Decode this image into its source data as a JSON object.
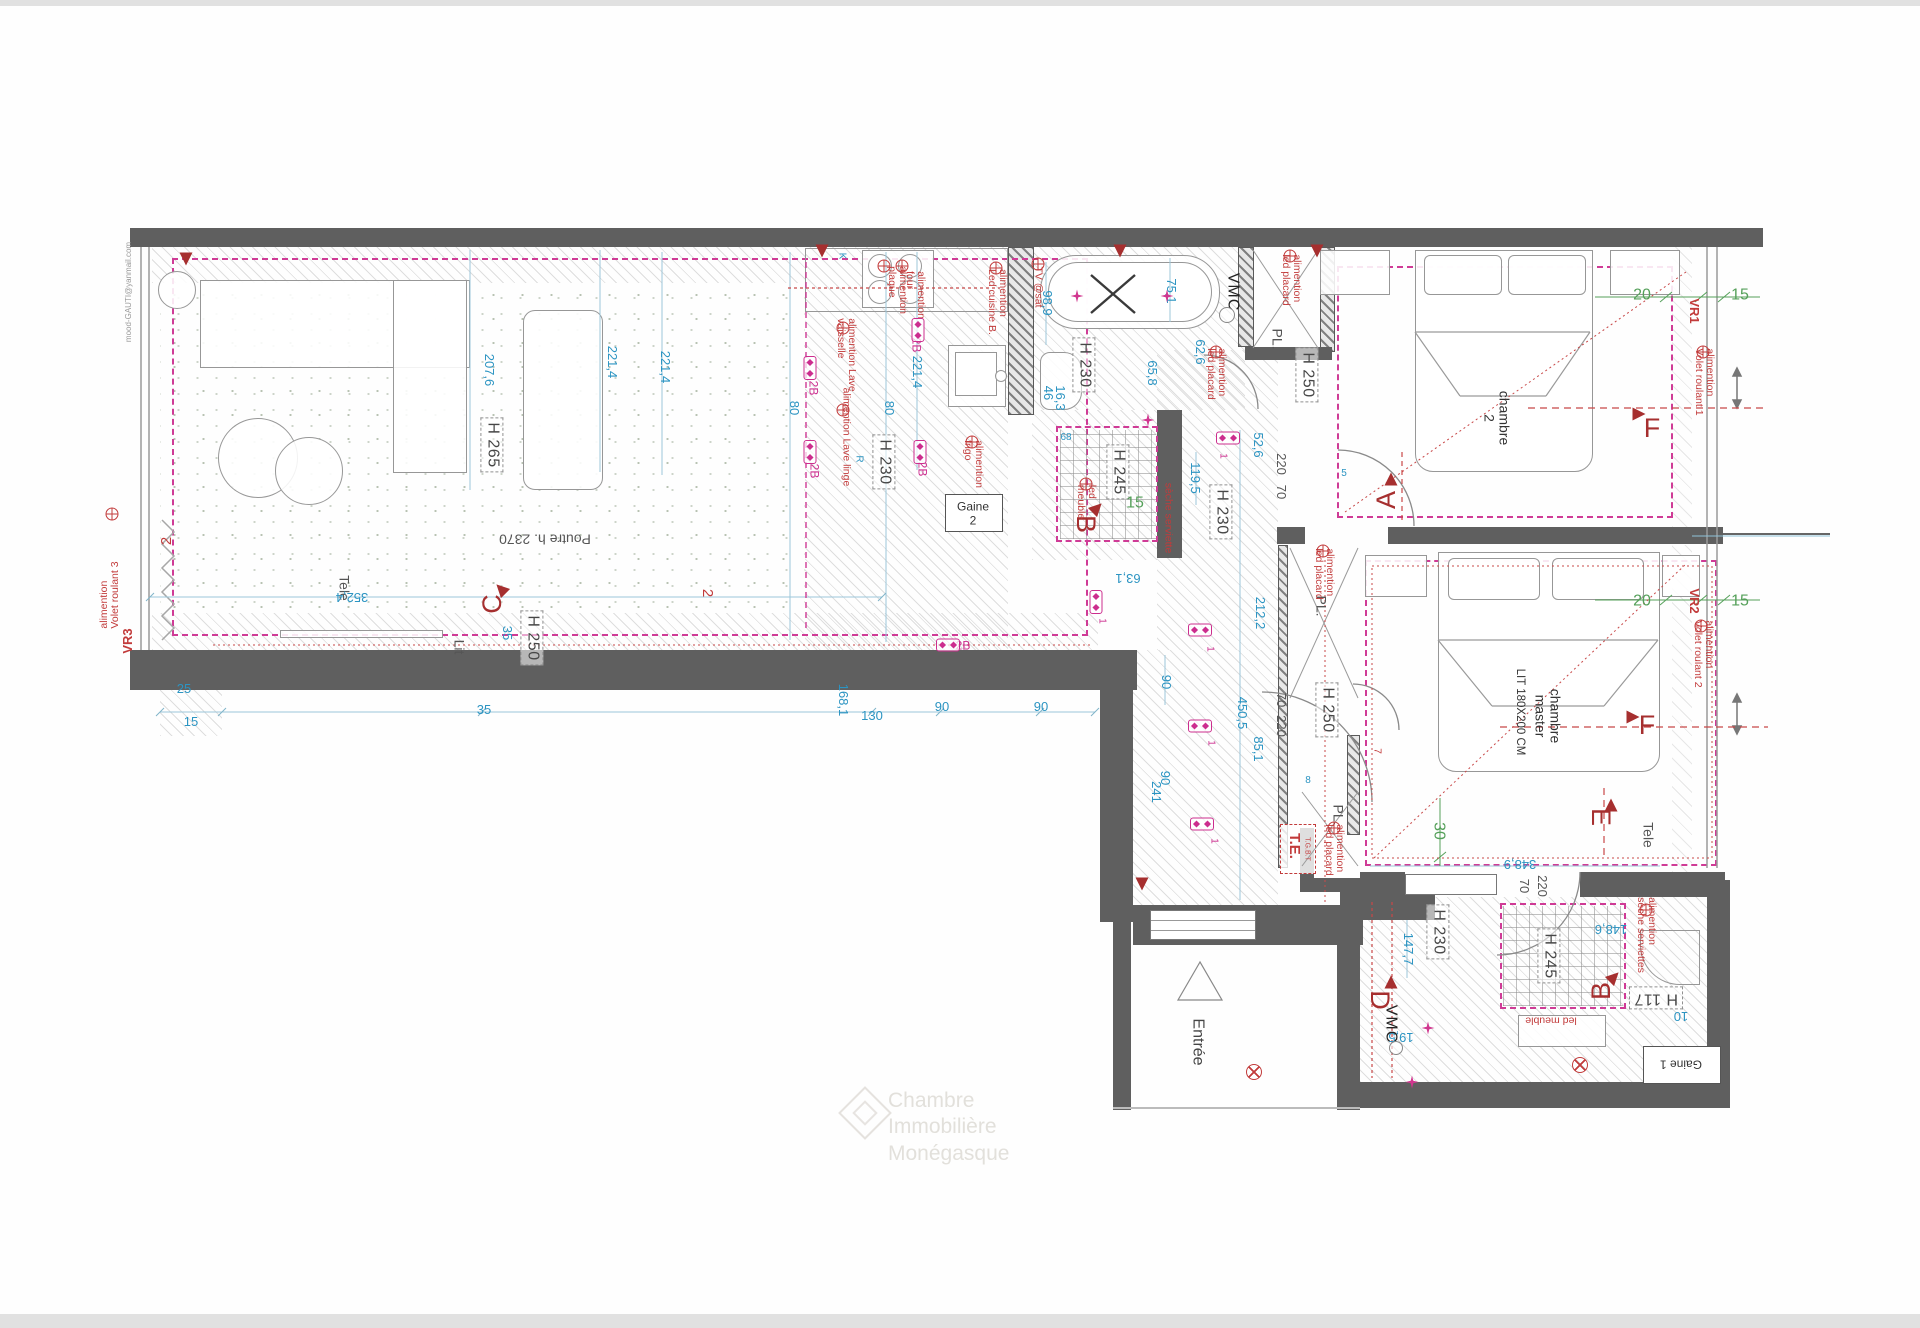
{
  "plan_title": "Plan appartement - implantation électrique",
  "watermark": {
    "line1": "Chambre",
    "line2": "Immobilière",
    "line3": "Monégasque"
  },
  "edge_note": "mood-GAUTI@yanmail.com",
  "colors": {
    "wall": "#5f5f5f",
    "dim_blue": "#2b94c2",
    "dim_green": "#55a05a",
    "note_red": "#c23b3b",
    "magenta": "#cc2d8e",
    "ceiling_dash": "#cf3b96"
  },
  "labels": [
    {
      "t": "H 265",
      "x": 492,
      "y": 445,
      "r": 90,
      "c": "hbox"
    },
    {
      "t": "H 230",
      "x": 884,
      "y": 462,
      "r": 90,
      "c": "hbox"
    },
    {
      "t": "H 250",
      "x": 532,
      "y": 638,
      "r": 90,
      "c": "hbox"
    },
    {
      "t": "H 230",
      "x": 1084,
      "y": 365,
      "r": 90,
      "c": "hbox"
    },
    {
      "t": "H 250",
      "x": 1307,
      "y": 375,
      "r": 90,
      "c": "hbox"
    },
    {
      "t": "H 230",
      "x": 1221,
      "y": 512,
      "r": 90,
      "c": "hbox"
    },
    {
      "t": "H 245",
      "x": 1118,
      "y": 472,
      "r": 90,
      "c": "hbox"
    },
    {
      "t": "H 250",
      "x": 1327,
      "y": 710,
      "r": 90,
      "c": "hbox"
    },
    {
      "t": "H 230",
      "x": 1438,
      "y": 932,
      "r": 90,
      "c": "hbox"
    },
    {
      "t": "H 245",
      "x": 1549,
      "y": 956,
      "r": 90,
      "c": "hbox"
    },
    {
      "t": "H 117",
      "x": 1656,
      "y": 998,
      "r": 180,
      "c": "hbox"
    },
    {
      "t": "Poutre h. 2370",
      "x": 545,
      "y": 539,
      "r": 180,
      "c": "graysm2"
    },
    {
      "t": "chambre\n2",
      "x": 1497,
      "y": 418,
      "r": 90,
      "c": "room"
    },
    {
      "t": "chambre\nmaster",
      "x": 1548,
      "y": 716,
      "r": 90,
      "c": "room"
    },
    {
      "t": "LIT 180X200 CM",
      "x": 1520,
      "y": 712,
      "r": 90,
      "c": "room-sm"
    },
    {
      "t": "Entrée",
      "x": 1197,
      "y": 1042,
      "r": 90,
      "c": "entree"
    },
    {
      "t": "Tele",
      "x": 344,
      "y": 588,
      "r": 90,
      "c": "graysm2"
    },
    {
      "t": "Tele",
      "x": 1648,
      "y": 835,
      "r": 90,
      "c": "graysm2"
    },
    {
      "t": "Lit",
      "x": 459,
      "y": 647,
      "r": 90,
      "c": "graysm2"
    },
    {
      "t": "VMC",
      "x": 1232,
      "y": 292,
      "r": 90,
      "c": "vmc"
    },
    {
      "t": "VMC",
      "x": 1390,
      "y": 1024,
      "r": 90,
      "c": "vmc"
    },
    {
      "t": "PL.",
      "x": 1277,
      "y": 339,
      "r": 90,
      "c": "graysm2"
    },
    {
      "t": "PL.",
      "x": 1321,
      "y": 606,
      "r": 90,
      "c": "graysm2"
    },
    {
      "t": "PL.",
      "x": 1338,
      "y": 815,
      "r": 90,
      "c": "graysm2"
    },
    {
      "t": "Gaine",
      "x": 973,
      "y": 507,
      "r": 0,
      "c": "gainetxt"
    },
    {
      "t": "2",
      "x": 973,
      "y": 521,
      "r": 0,
      "c": "gainetxt"
    },
    {
      "t": "Gaine 1",
      "x": 1681,
      "y": 1064,
      "r": 180,
      "c": "gainetxt"
    },
    {
      "t": "T.E.",
      "x": 1294,
      "y": 846,
      "r": 90,
      "c": "tebig"
    },
    {
      "t": "T.G.B.T",
      "x": 1307,
      "y": 849,
      "r": 90,
      "c": "tesm"
    },
    {
      "t": "207,6",
      "x": 489,
      "y": 370,
      "r": 90,
      "c": "dim"
    },
    {
      "t": "221,4",
      "x": 612,
      "y": 362,
      "r": 90,
      "c": "dim"
    },
    {
      "t": "221,4",
      "x": 665,
      "y": 367,
      "r": 90,
      "c": "dim"
    },
    {
      "t": "221,4",
      "x": 917,
      "y": 372,
      "r": 90,
      "c": "dim"
    },
    {
      "t": "80",
      "x": 794,
      "y": 408,
      "r": 90,
      "c": "dim"
    },
    {
      "t": "80",
      "x": 889,
      "y": 408,
      "r": 90,
      "c": "dim"
    },
    {
      "t": "352,4",
      "x": 352,
      "y": 597,
      "r": 180,
      "c": "dim"
    },
    {
      "t": "35",
      "x": 507,
      "y": 633,
      "r": 90,
      "c": "dim"
    },
    {
      "t": "25",
      "x": 184,
      "y": 689,
      "r": 0,
      "c": "dim"
    },
    {
      "t": "15",
      "x": 191,
      "y": 722,
      "r": 0,
      "c": "dim"
    },
    {
      "t": "35",
      "x": 484,
      "y": 710,
      "r": 0,
      "c": "dim"
    },
    {
      "t": "168,1",
      "x": 843,
      "y": 700,
      "r": 90,
      "c": "dim"
    },
    {
      "t": "130",
      "x": 872,
      "y": 716,
      "r": 0,
      "c": "dim"
    },
    {
      "t": "90",
      "x": 942,
      "y": 707,
      "r": 0,
      "c": "dim"
    },
    {
      "t": "90",
      "x": 1041,
      "y": 707,
      "r": 0,
      "c": "dim"
    },
    {
      "t": "98,9",
      "x": 1047,
      "y": 303,
      "r": 90,
      "c": "dim"
    },
    {
      "t": "75,1",
      "x": 1171,
      "y": 291,
      "r": 90,
      "c": "dim"
    },
    {
      "t": "46",
      "x": 1048,
      "y": 393,
      "r": 90,
      "c": "dim"
    },
    {
      "t": "16,3",
      "x": 1060,
      "y": 398,
      "r": 90,
      "c": "dim"
    },
    {
      "t": "65,8",
      "x": 1152,
      "y": 373,
      "r": 90,
      "c": "dim"
    },
    {
      "t": "62,6",
      "x": 1200,
      "y": 352,
      "r": 90,
      "c": "dim"
    },
    {
      "t": "52,6",
      "x": 1258,
      "y": 445,
      "r": 90,
      "c": "dim"
    },
    {
      "t": "119,5",
      "x": 1195,
      "y": 478,
      "r": 90,
      "c": "dim"
    },
    {
      "t": "212,2",
      "x": 1260,
      "y": 613,
      "r": 90,
      "c": "dim"
    },
    {
      "t": "63,1",
      "x": 1128,
      "y": 578,
      "r": 180,
      "c": "dim"
    },
    {
      "t": "90",
      "x": 1166,
      "y": 682,
      "r": 90,
      "c": "dim"
    },
    {
      "t": "450,5",
      "x": 1242,
      "y": 713,
      "r": 90,
      "c": "dim"
    },
    {
      "t": "85,1",
      "x": 1258,
      "y": 749,
      "r": 90,
      "c": "dim"
    },
    {
      "t": "90",
      "x": 1165,
      "y": 778,
      "r": 90,
      "c": "dim"
    },
    {
      "t": "241",
      "x": 1156,
      "y": 792,
      "r": 90,
      "c": "dim"
    },
    {
      "t": "147,7",
      "x": 1408,
      "y": 949,
      "r": 90,
      "c": "dim"
    },
    {
      "t": "148,6",
      "x": 1611,
      "y": 929,
      "r": 180,
      "c": "dim"
    },
    {
      "t": "19,5",
      "x": 1401,
      "y": 1037,
      "r": 180,
      "c": "dim"
    },
    {
      "t": "10",
      "x": 1681,
      "y": 1016,
      "r": 180,
      "c": "dim"
    },
    {
      "t": "348,9",
      "x": 1520,
      "y": 864,
      "r": 180,
      "c": "dim"
    },
    {
      "t": "68",
      "x": 1066,
      "y": 438,
      "r": 0,
      "c": "dimsm"
    },
    {
      "t": "5",
      "x": 1344,
      "y": 474,
      "r": 0,
      "c": "dimsm"
    },
    {
      "t": "8",
      "x": 1308,
      "y": 781,
      "r": 0,
      "c": "dimsm"
    },
    {
      "t": "R",
      "x": 858,
      "y": 459,
      "r": 90,
      "c": "dimsm"
    },
    {
      "t": "K",
      "x": 841,
      "y": 256,
      "r": 90,
      "c": "dimsm"
    },
    {
      "t": "220",
      "x": 1281,
      "y": 464,
      "r": 90,
      "c": "dimgray"
    },
    {
      "t": "70",
      "x": 1281,
      "y": 492,
      "r": 90,
      "c": "dimgray"
    },
    {
      "t": "70",
      "x": 1281,
      "y": 700,
      "r": 90,
      "c": "dimgray"
    },
    {
      "t": "220",
      "x": 1281,
      "y": 726,
      "r": 90,
      "c": "dimgray"
    },
    {
      "t": "70",
      "x": 1524,
      "y": 886,
      "r": 90,
      "c": "dimgray"
    },
    {
      "t": "220",
      "x": 1542,
      "y": 886,
      "r": 90,
      "c": "dimgray"
    },
    {
      "t": "20",
      "x": 1642,
      "y": 296,
      "r": 0,
      "c": "dimg"
    },
    {
      "t": "15",
      "x": 1740,
      "y": 296,
      "r": 0,
      "c": "dimg"
    },
    {
      "t": "20",
      "x": 1642,
      "y": 602,
      "r": 0,
      "c": "dimg"
    },
    {
      "t": "15",
      "x": 1740,
      "y": 602,
      "r": 0,
      "c": "dimg"
    },
    {
      "t": "15",
      "x": 1135,
      "y": 504,
      "r": 0,
      "c": "dimg"
    },
    {
      "t": "30",
      "x": 1438,
      "y": 831,
      "r": 90,
      "c": "dimg"
    },
    {
      "t": "C",
      "x": 492,
      "y": 604,
      "r": 270,
      "c": "marker"
    },
    {
      "t": "A",
      "x": 1386,
      "y": 500,
      "r": 270,
      "c": "marker"
    },
    {
      "t": "F",
      "x": 1652,
      "y": 428,
      "r": 0,
      "c": "marker"
    },
    {
      "t": "F",
      "x": 1647,
      "y": 725,
      "r": 0,
      "c": "marker"
    },
    {
      "t": "E",
      "x": 1601,
      "y": 817,
      "r": 90,
      "c": "marker"
    },
    {
      "t": "B",
      "x": 1086,
      "y": 524,
      "r": 90,
      "c": "marker"
    },
    {
      "t": "B",
      "x": 1601,
      "y": 991,
      "r": 270,
      "c": "marker"
    },
    {
      "t": "D",
      "x": 1380,
      "y": 1000,
      "r": 90,
      "c": "marker"
    },
    {
      "t": "2",
      "x": 167,
      "y": 541,
      "r": 270,
      "c": "redmid"
    },
    {
      "t": "2",
      "x": 707,
      "y": 593,
      "r": 90,
      "c": "redmid"
    },
    {
      "t": "7",
      "x": 1376,
      "y": 751,
      "r": 90,
      "c": "redsm"
    },
    {
      "t": "alimention\nVolet roulant 3",
      "x": 110,
      "y": 595,
      "r": 270,
      "c": "red"
    },
    {
      "t": "VR3",
      "x": 128,
      "y": 641,
      "r": 270,
      "c": "vr"
    },
    {
      "t": "TV @sat",
      "x": 1038,
      "y": 287,
      "r": 90,
      "c": "red"
    },
    {
      "t": "alimention\nplaque",
      "x": 897,
      "y": 290,
      "r": 90,
      "c": "red"
    },
    {
      "t": "alimention\nfour",
      "x": 915,
      "y": 295,
      "r": 90,
      "c": "red"
    },
    {
      "t": "alimention\nLed cuisine B.",
      "x": 997,
      "y": 302,
      "r": 90,
      "c": "red"
    },
    {
      "t": "alimention Lave\nvaisselle",
      "x": 846,
      "y": 355,
      "r": 90,
      "c": "red"
    },
    {
      "t": "alimention Lave linge",
      "x": 846,
      "y": 437,
      "r": 90,
      "c": "red"
    },
    {
      "t": "alimention\nfrigo",
      "x": 973,
      "y": 464,
      "r": 90,
      "c": "red"
    },
    {
      "t": "alimention\nled placard",
      "x": 1291,
      "y": 280,
      "r": 90,
      "c": "red"
    },
    {
      "t": "alimention\nled placard",
      "x": 1216,
      "y": 374,
      "r": 90,
      "c": "red"
    },
    {
      "t": "alimention\nled placard",
      "x": 1324,
      "y": 574,
      "r": 90,
      "c": "red"
    },
    {
      "t": "alimention\nled placard",
      "x": 1334,
      "y": 850,
      "r": 90,
      "c": "red"
    },
    {
      "t": "sèche serviette",
      "x": 1168,
      "y": 518,
      "r": 90,
      "c": "red"
    },
    {
      "t": "alimention\nsèche serviettes",
      "x": 1646,
      "y": 935,
      "r": 90,
      "c": "red"
    },
    {
      "t": "led meuble",
      "x": 1551,
      "y": 1020,
      "r": 180,
      "c": "red"
    },
    {
      "t": "led\nmeuble",
      "x": 1086,
      "y": 502,
      "r": 90,
      "c": "red"
    },
    {
      "t": "VR1",
      "x": 1694,
      "y": 311,
      "r": 90,
      "c": "vr"
    },
    {
      "t": "alimention\nVolet roulant 1",
      "x": 1704,
      "y": 382,
      "r": 90,
      "c": "red"
    },
    {
      "t": "VR2",
      "x": 1694,
      "y": 601,
      "r": 90,
      "c": "vr"
    },
    {
      "t": "alimention\nVolet roulant 2",
      "x": 1703,
      "y": 654,
      "r": 90,
      "c": "red"
    },
    {
      "t": "2B",
      "x": 813,
      "y": 388,
      "r": 90,
      "c": "mag"
    },
    {
      "t": "2B",
      "x": 814,
      "y": 471,
      "r": 90,
      "c": "mag"
    },
    {
      "t": "2B",
      "x": 916,
      "y": 345,
      "r": 90,
      "c": "mag"
    },
    {
      "t": "2B",
      "x": 922,
      "y": 469,
      "r": 90,
      "c": "mag"
    },
    {
      "t": "2B",
      "x": 963,
      "y": 646,
      "r": 0,
      "c": "mag"
    },
    {
      "t": "1",
      "x": 1222,
      "y": 456,
      "r": 90,
      "c": "magsm"
    },
    {
      "t": "1",
      "x": 1101,
      "y": 621,
      "r": 90,
      "c": "magsm"
    },
    {
      "t": "1",
      "x": 1209,
      "y": 649,
      "r": 90,
      "c": "magsm"
    },
    {
      "t": "1",
      "x": 1210,
      "y": 743,
      "r": 90,
      "c": "magsm"
    },
    {
      "t": "1",
      "x": 1213,
      "y": 841,
      "r": 90,
      "c": "magsm"
    },
    {
      "t": "mood-GAUTI@yanmail.com",
      "x": 129,
      "y": 292,
      "r": 270,
      "c": "email"
    }
  ],
  "symbols": {
    "sockets": [
      [
        810,
        368,
        90
      ],
      [
        810,
        452,
        90
      ],
      [
        918,
        330,
        90
      ],
      [
        920,
        452,
        90
      ],
      [
        948,
        645,
        0
      ],
      [
        1228,
        438,
        0
      ],
      [
        1096,
        602,
        90
      ],
      [
        1200,
        630,
        0
      ],
      [
        1200,
        726,
        0
      ],
      [
        1202,
        824,
        0
      ]
    ],
    "stars": [
      [
        1077,
        296
      ],
      [
        1167,
        296
      ],
      [
        1148,
        420
      ],
      [
        1428,
        1028
      ],
      [
        1412,
        1082
      ]
    ],
    "circlex": [
      [
        1254,
        1072
      ],
      [
        1580,
        1065
      ]
    ],
    "powers": [
      [
        884,
        266
      ],
      [
        902,
        266
      ],
      [
        996,
        268
      ],
      [
        843,
        328
      ],
      [
        843,
        410
      ],
      [
        972,
        442
      ],
      [
        1290,
        256
      ],
      [
        1216,
        352
      ],
      [
        1323,
        551
      ],
      [
        1334,
        828
      ],
      [
        1646,
        910
      ],
      [
        112,
        514
      ],
      [
        1703,
        352
      ],
      [
        1701,
        626
      ],
      [
        1038,
        264
      ],
      [
        1086,
        484
      ]
    ],
    "triangles": [
      [
        501,
        589,
        315
      ],
      [
        1391,
        479,
        0
      ],
      [
        1639,
        414,
        90
      ],
      [
        1633,
        717,
        90
      ],
      [
        1611,
        805,
        0
      ],
      [
        1097,
        508,
        45
      ],
      [
        1614,
        977,
        45
      ],
      [
        1391,
        982,
        0
      ],
      [
        186,
        259,
        180
      ],
      [
        822,
        251,
        180
      ],
      [
        1120,
        251,
        180
      ],
      [
        1317,
        251,
        180
      ],
      [
        1142,
        884,
        180
      ]
    ],
    "vmc_circles": [
      [
        1227,
        315,
        14
      ],
      [
        1396,
        1048,
        12
      ]
    ]
  }
}
